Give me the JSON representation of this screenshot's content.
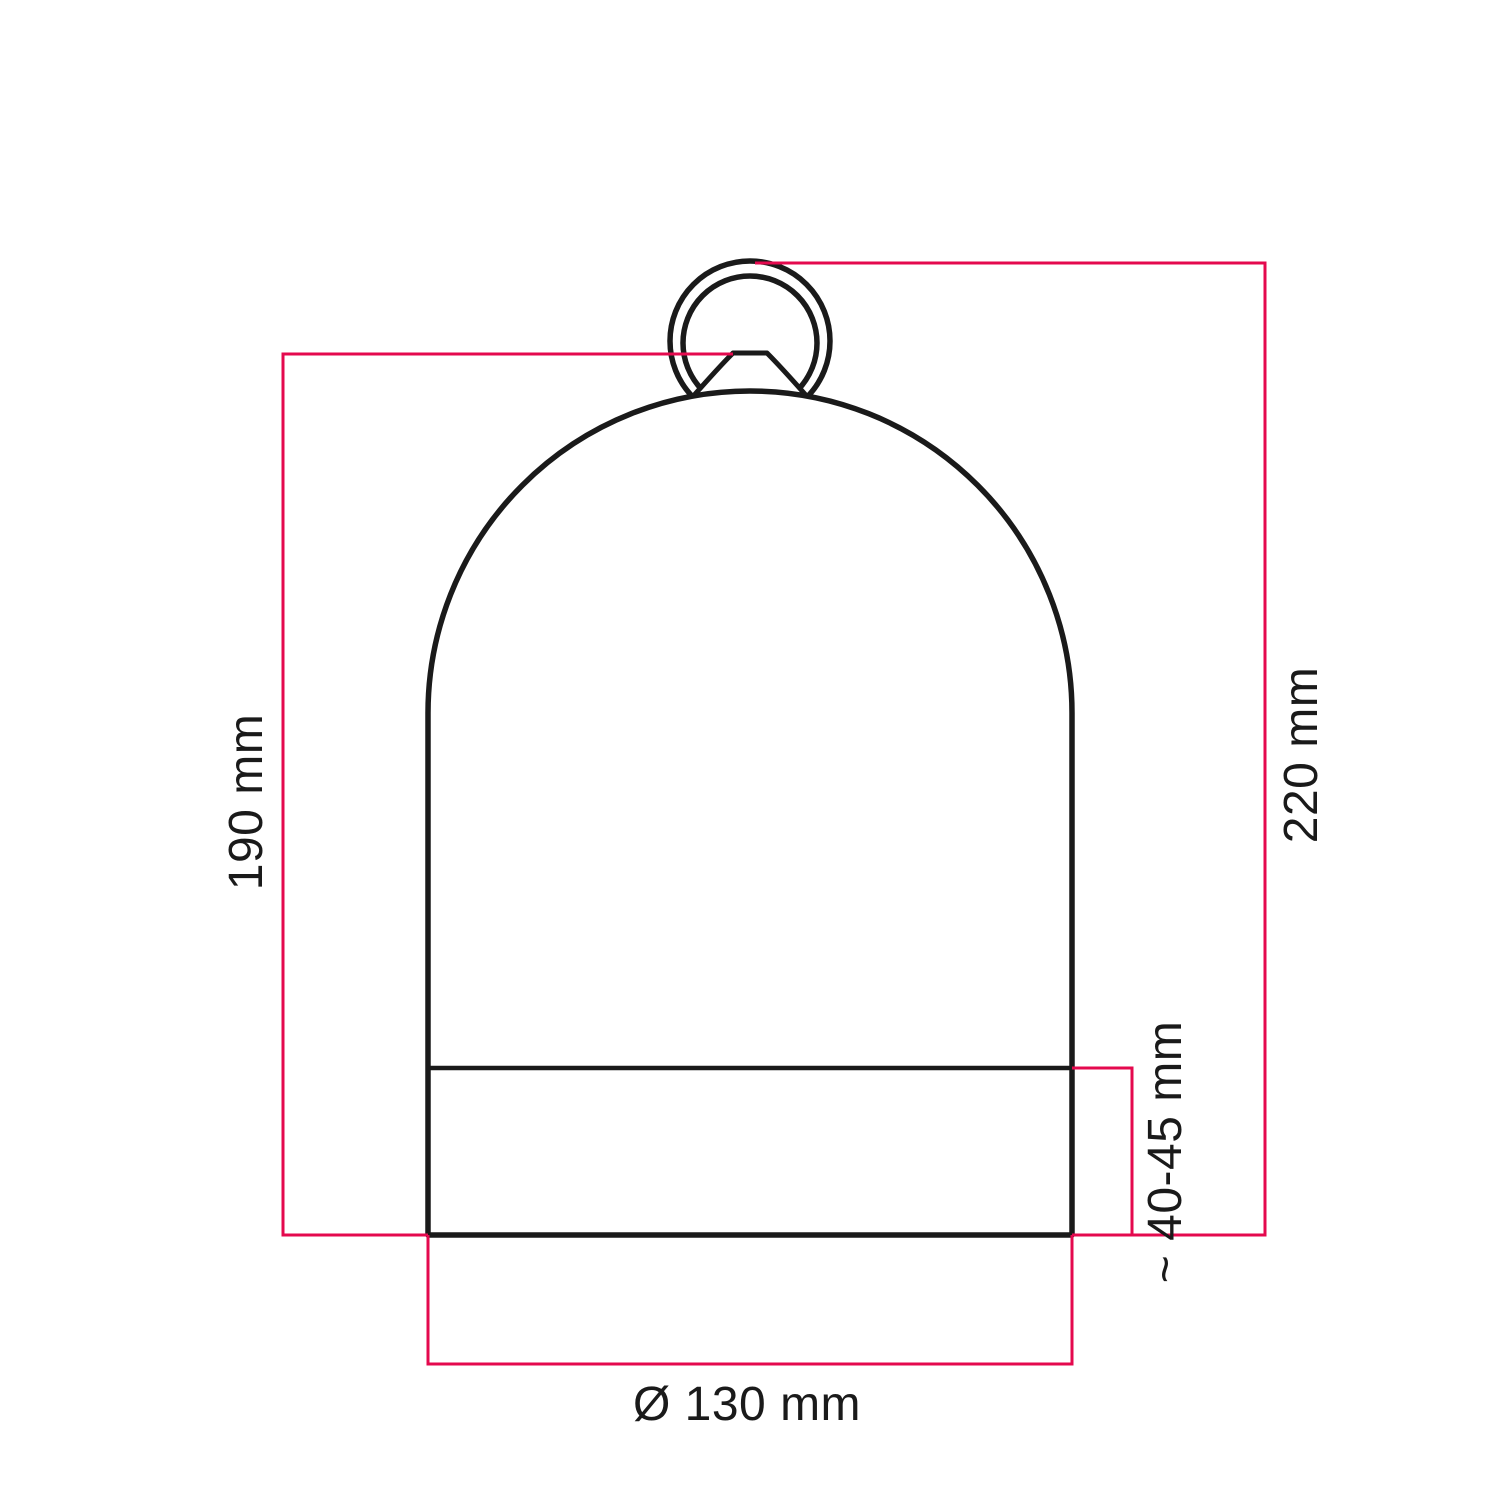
{
  "colors": {
    "background": "#ffffff",
    "accent": "#e4094e",
    "line": "#1a1a1a",
    "text": "#1a1a1a"
  },
  "figure": {
    "subject": "bell dome lampshade with hanging ring",
    "type": "technical dimension drawing"
  },
  "dimensions": {
    "dome_height": {
      "label": "190 mm"
    },
    "total_height": {
      "label": "220 mm"
    },
    "base_band_height": {
      "label": "~ 40-45 mm"
    },
    "base_diameter": {
      "label": "Ø 130 mm"
    }
  }
}
